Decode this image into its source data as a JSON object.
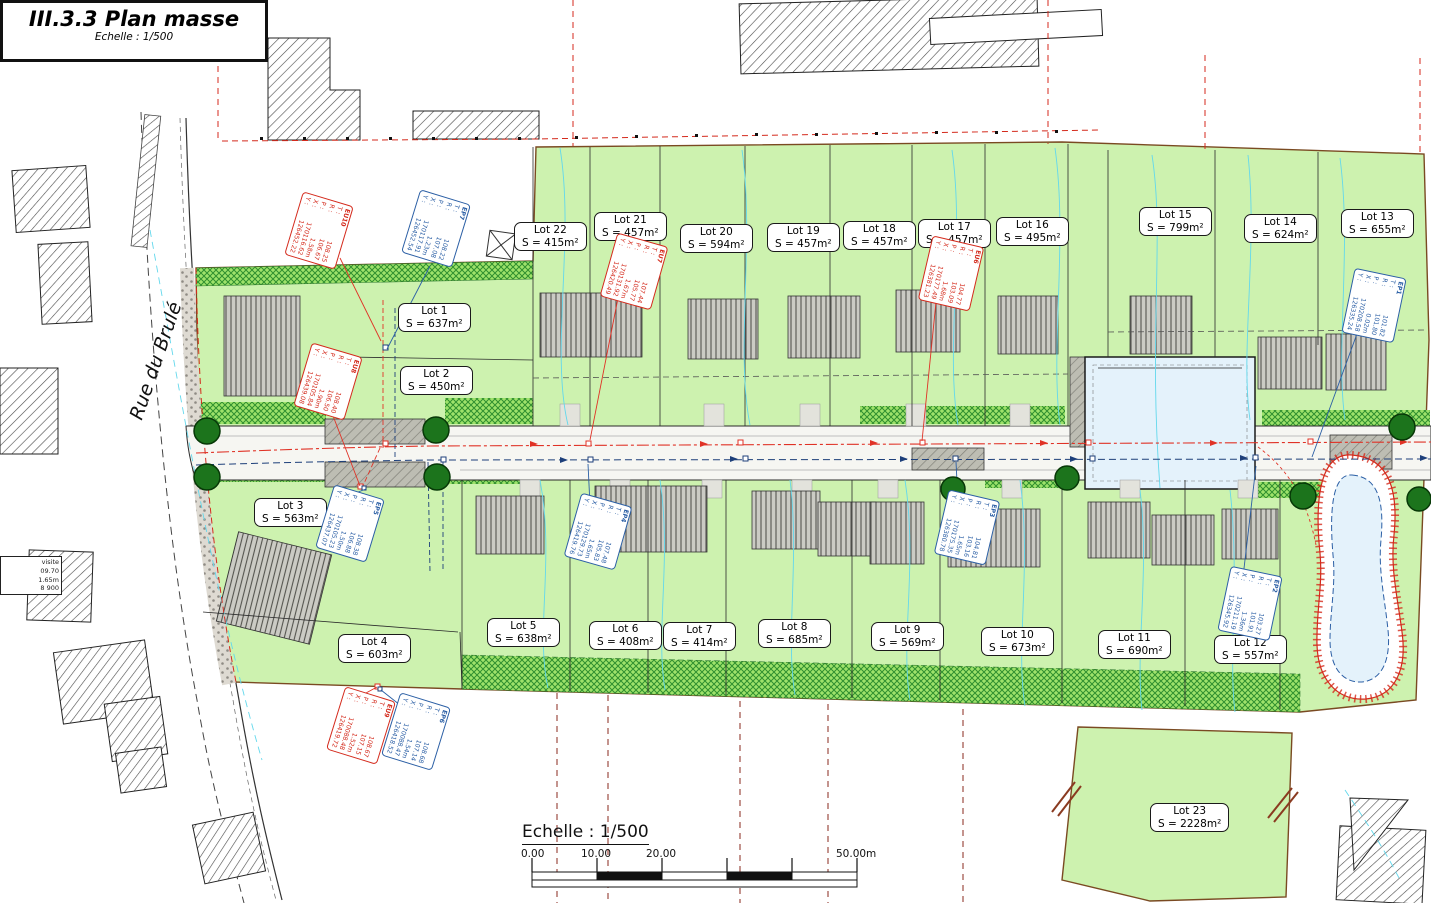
{
  "title_block": {
    "title": "III.3.3 Plan masse",
    "subtitle": "Echelle : 1/500"
  },
  "street_label": "Rue du Brulé",
  "scale_bar": {
    "label": "Echelle : 1/500",
    "t0": "0.00",
    "t1": "10.00",
    "t2": "20.00",
    "t3": "50.00m"
  },
  "row_labels": {
    "t": "T :",
    "r": "R :",
    "p": "P :",
    "x": "X :",
    "y": "Y :"
  },
  "visite_box": {
    "l1": "visite",
    "l2": "09.70",
    "l3": "1.65m",
    "l4": "8 900"
  },
  "lots": [
    {
      "id": "Lot 1",
      "name": "Lot 1",
      "area": "S = 637m²",
      "x": 398,
      "y": 303
    },
    {
      "id": "Lot 2",
      "name": "Lot 2",
      "area": "S = 450m²",
      "x": 400,
      "y": 366
    },
    {
      "id": "Lot 3",
      "name": "Lot 3",
      "area": "S = 563m²",
      "x": 254,
      "y": 498
    },
    {
      "id": "Lot 4",
      "name": "Lot 4",
      "area": "S = 603m²",
      "x": 338,
      "y": 634
    },
    {
      "id": "Lot 5",
      "name": "Lot 5",
      "area": "S = 638m²",
      "x": 487,
      "y": 618
    },
    {
      "id": "Lot 6",
      "name": "Lot 6",
      "area": "S = 408m²",
      "x": 589,
      "y": 621
    },
    {
      "id": "Lot 7",
      "name": "Lot 7",
      "area": "S = 414m²",
      "x": 663,
      "y": 622
    },
    {
      "id": "Lot 8",
      "name": "Lot 8",
      "area": "S = 685m²",
      "x": 758,
      "y": 619
    },
    {
      "id": "Lot 9",
      "name": "Lot 9",
      "area": "S = 569m²",
      "x": 871,
      "y": 622
    },
    {
      "id": "Lot 10",
      "name": "Lot 10",
      "area": "S = 673m²",
      "x": 981,
      "y": 627
    },
    {
      "id": "Lot 11",
      "name": "Lot 11",
      "area": "S = 690m²",
      "x": 1098,
      "y": 630
    },
    {
      "id": "Lot 12",
      "name": "Lot 12",
      "area": "S = 557m²",
      "x": 1214,
      "y": 635
    },
    {
      "id": "Lot 13",
      "name": "Lot 13",
      "area": "S = 655m²",
      "x": 1341,
      "y": 209
    },
    {
      "id": "Lot 14",
      "name": "Lot 14",
      "area": "S = 624m²",
      "x": 1244,
      "y": 214
    },
    {
      "id": "Lot 15",
      "name": "Lot 15",
      "area": "S = 799m²",
      "x": 1139,
      "y": 207
    },
    {
      "id": "Lot 16",
      "name": "Lot 16",
      "area": "S = 495m²",
      "x": 996,
      "y": 217
    },
    {
      "id": "Lot 17",
      "name": "Lot 17",
      "area": "S = 457m²",
      "x": 918,
      "y": 219
    },
    {
      "id": "Lot 18",
      "name": "Lot 18",
      "area": "S = 457m²",
      "x": 843,
      "y": 221
    },
    {
      "id": "Lot 19",
      "name": "Lot 19",
      "area": "S = 457m²",
      "x": 767,
      "y": 223
    },
    {
      "id": "Lot 20",
      "name": "Lot 20",
      "area": "S = 594m²",
      "x": 680,
      "y": 224
    },
    {
      "id": "Lot 21",
      "name": "Lot 21",
      "area": "S = 457m²",
      "x": 594,
      "y": 212
    },
    {
      "id": "Lot 22",
      "name": "Lot 22",
      "area": "S = 415m²",
      "x": 514,
      "y": 222
    },
    {
      "id": "Lot 23",
      "name": "Lot 23",
      "area": "S = 2228m²",
      "x": 1150,
      "y": 803
    }
  ],
  "manholes": [
    {
      "id": "EU10",
      "type": "eu",
      "x": 286,
      "y": 204,
      "t": "108.25",
      "r": "106.67",
      "p": "1.58m",
      "cx": "170116.62",
      "cy": "126452.22"
    },
    {
      "id": "EP7",
      "type": "ep",
      "x": 403,
      "y": 202,
      "t": "108.22",
      "r": "107.08",
      "p": "1.23m",
      "cx": "170117.91",
      "cy": "126452.54"
    },
    {
      "id": "EU8",
      "type": "eu",
      "x": 295,
      "y": 355,
      "t": "108.40",
      "r": "106.50",
      "p": "1.90m",
      "cx": "170105.84",
      "cy": "126439.08"
    },
    {
      "id": "EU7",
      "type": "eu",
      "x": 601,
      "y": 245,
      "t": "107.44",
      "r": "105.77",
      "p": "1.67m",
      "cx": "170131.92",
      "cy": "126420.49"
    },
    {
      "id": "EU6",
      "type": "eu",
      "x": 918,
      "y": 247,
      "t": "104.77",
      "r": "103.09",
      "p": "1.68m",
      "cx": "170177.49",
      "cy": "126381.23"
    },
    {
      "id": "EP5",
      "type": "ep",
      "x": 317,
      "y": 497,
      "t": "108.38",
      "r": "106.88",
      "p": "1.50m",
      "cx": "170105.23",
      "cy": "126437.07"
    },
    {
      "id": "EU9",
      "type": "eu",
      "x": 328,
      "y": 699,
      "t": "108.67",
      "r": "107.15",
      "p": "1.52m",
      "cx": "170088.48",
      "cy": "126419.72"
    },
    {
      "id": "EP6",
      "type": "ep",
      "x": 383,
      "y": 705,
      "t": "108.68",
      "r": "107.14",
      "p": "1.54m",
      "cx": "170088.47",
      "cy": "126418.52"
    },
    {
      "id": "EP4",
      "type": "ep",
      "x": 565,
      "y": 505,
      "t": "107.48",
      "r": "105.83",
      "p": "1.65m",
      "cx": "170129.73",
      "cy": "126419.76"
    },
    {
      "id": "EP3",
      "type": "ep",
      "x": 934,
      "y": 501,
      "t": "104.81",
      "r": "103.16",
      "p": "1.65m",
      "cx": "170175.35",
      "cy": "126380.78"
    },
    {
      "id": "EP2",
      "type": "ep",
      "x": 1217,
      "y": 577,
      "t": "103.27",
      "r": "101.91",
      "p": "1.36m",
      "cx": "170211.19",
      "cy": "126345.92"
    },
    {
      "id": "EP1",
      "type": "ep",
      "x": 1341,
      "y": 279,
      "t": "101.82",
      "r": "101.80",
      "p": "0.02m",
      "cx": "170208.58",
      "cy": "126335.24"
    }
  ],
  "parcels": [
    {
      "t": "274F",
      "x": 408,
      "y": 48
    },
    {
      "t": "274E",
      "x": 843,
      "y": 18
    },
    {
      "t": "272E",
      "x": 370,
      "y": 192
    },
    {
      "t": "272G",
      "x": 370,
      "y": 284
    },
    {
      "t": "271L",
      "x": 350,
      "y": 360
    },
    {
      "t": "268C",
      "x": 406,
      "y": 528
    },
    {
      "t": "380W",
      "x": 298,
      "y": 708
    },
    {
      "t": "379A2",
      "x": 430,
      "y": 742
    },
    {
      "t": "379C2",
      "x": 500,
      "y": 728
    },
    {
      "t": "378W2",
      "x": 566,
      "y": 730
    },
    {
      "t": "378T2",
      "x": 655,
      "y": 745
    },
    {
      "t": "378V2",
      "x": 766,
      "y": 757
    },
    {
      "t": "378S2",
      "x": 868,
      "y": 770
    },
    {
      "t": "377",
      "x": 1178,
      "y": 775
    },
    {
      "t": "376R",
      "x": 1362,
      "y": 840
    },
    {
      "t": "389Z8",
      "x": 1084,
      "y": 884
    },
    {
      "t": "389S",
      "x": 1140,
      "y": 888
    },
    {
      "t": "389T",
      "x": 1196,
      "y": 891
    }
  ],
  "parking": [
    {
      "t": "Parking",
      "x": 336,
      "y": 423
    },
    {
      "t": "Parking",
      "x": 336,
      "y": 467
    },
    {
      "t": "Parking",
      "x": 922,
      "y": 451
    },
    {
      "t": "Parking",
      "x": 1070,
      "y": 384
    },
    {
      "t": "Parking",
      "x": 1342,
      "y": 441,
      "r": -8
    }
  ],
  "pipes": [
    {
      "t": "PVC DN315 32.00m  -2.29%",
      "x": 440,
      "y": 431,
      "r": -12,
      "c": "r"
    },
    {
      "t": "PVC DN315 30.00m  -2.50%",
      "x": 442,
      "y": 455,
      "r": -9,
      "c": "b"
    },
    {
      "t": "PVC DN315 60.25m  -4.47%",
      "x": 740,
      "y": 418,
      "r": -3,
      "c": "r"
    },
    {
      "t": "PVC DN315 60.00m  -4.96%",
      "x": 742,
      "y": 443,
      "r": -3,
      "c": "b"
    },
    {
      "t": "PVC DN315 62.23m  -3.70%",
      "x": 1128,
      "y": 429,
      "r": -5,
      "c": "r"
    },
    {
      "t": "PVC DN315 50.00m  -2.50%",
      "x": 1084,
      "y": 443,
      "r": -2,
      "c": "b"
    },
    {
      "t": "PVC DN200 17.00m",
      "x": 371,
      "y": 430,
      "r": -90,
      "c": "r"
    },
    {
      "t": "PVC DN200 17.00m",
      "x": 398,
      "y": 430,
      "r": -90,
      "c": "b"
    },
    {
      "t": "PVC DN200 26.00m  -2.53%",
      "x": 425,
      "y": 575,
      "r": -90,
      "c": "b"
    },
    {
      "t": "PVC DN200 26.00m  -1.00%",
      "x": 450,
      "y": 575,
      "r": -90,
      "c": "r"
    },
    {
      "t": "DN315 3.00m",
      "x": 1296,
      "y": 472,
      "r": -58,
      "c": "b"
    }
  ],
  "dims": [
    {
      "t": "-8.31m-",
      "x": 549,
      "y": 143
    },
    {
      "t": "-11.50m-",
      "x": 612,
      "y": 143
    },
    {
      "t": "-14.99m-",
      "x": 688,
      "y": 142
    },
    {
      "t": "-11.50m-",
      "x": 776,
      "y": 142
    },
    {
      "t": "-11.90m-",
      "x": 846,
      "y": 141
    },
    {
      "t": "-11.50m-",
      "x": 914,
      "y": 141
    },
    {
      "t": "-13.41m-",
      "x": 998,
      "y": 142
    },
    {
      "t": "-15.41m-",
      "x": 1080,
      "y": 143
    },
    {
      "t": "-25.13m-",
      "x": 1146,
      "y": 142
    },
    {
      "t": "-13.04m-",
      "x": 1258,
      "y": 144
    },
    {
      "t": "-15.06m-",
      "x": 1356,
      "y": 146
    },
    {
      "t": "6.98m",
      "x": 146,
      "y": 140,
      "c": "k"
    },
    {
      "t": "-49.00m-",
      "x": 338,
      "y": 271
    },
    {
      "t": "-1.00m-",
      "x": 498,
      "y": 271
    },
    {
      "t": "-43.46m-",
      "x": 308,
      "y": 341,
      "r": -6
    },
    {
      "t": "1.50m",
      "x": 204,
      "y": 324,
      "c": "k"
    },
    {
      "t": "-37.97m-",
      "x": 316,
      "y": 407
    },
    {
      "t": "-38.70m-",
      "x": 306,
      "y": 483
    },
    {
      "t": "-33.67m-",
      "x": 323,
      "y": 671,
      "r": -4
    },
    {
      "t": "-4.73m-",
      "x": 188,
      "y": 298,
      "r": -72
    },
    {
      "t": "-6.44m-",
      "x": 194,
      "y": 324,
      "r": -72
    },
    {
      "t": "-8.78m-",
      "x": 190,
      "y": 362,
      "r": -76
    },
    {
      "t": "-3.68m-",
      "x": 188,
      "y": 489,
      "r": -78
    },
    {
      "t": "-6.99m-",
      "x": 48,
      "y": 646,
      "r": -80
    },
    {
      "t": "-6.7m-",
      "x": 78,
      "y": 830,
      "r": -15
    },
    {
      "t": "-5.08m-",
      "x": 446,
      "y": 401,
      "r": -20
    },
    {
      "t": "-6.00m-",
      "x": 482,
      "y": 360,
      "r": -65
    },
    {
      "t": "-6.15m-",
      "x": 574,
      "y": 388
    },
    {
      "t": "-14.94m-",
      "x": 710,
      "y": 387
    },
    {
      "t": "-11.50m-",
      "x": 788,
      "y": 387
    },
    {
      "t": "-11.50m-",
      "x": 856,
      "y": 388
    },
    {
      "t": "11.50m",
      "x": 926,
      "y": 388
    },
    {
      "t": "-12.43m-",
      "x": 994,
      "y": 389
    },
    {
      "t": "-26.13m-",
      "x": 1122,
      "y": 337
    },
    {
      "t": "-4.13m-",
      "x": 1222,
      "y": 338
    },
    {
      "t": "-11.00m-",
      "x": 1340,
      "y": 370,
      "r": -86
    },
    {
      "t": "-11.50m-",
      "x": 1278,
      "y": 403
    },
    {
      "t": "-15.55m-",
      "x": 1362,
      "y": 402
    },
    {
      "t": "-15.30m-",
      "x": 486,
      "y": 479,
      "r": -8
    },
    {
      "t": "-4.00m-",
      "x": 546,
      "y": 467
    },
    {
      "t": "-11.50m-",
      "x": 596,
      "y": 467
    },
    {
      "t": "-11.50m-",
      "x": 670,
      "y": 467
    },
    {
      "t": "-18.63m-",
      "x": 764,
      "y": 469
    },
    {
      "t": "-15.13m-",
      "x": 874,
      "y": 468
    },
    {
      "t": "-19.01m-",
      "x": 946,
      "y": 481,
      "r": -3
    },
    {
      "t": "-18.99m-",
      "x": 1100,
      "y": 478
    },
    {
      "t": "-15.00m-",
      "x": 1220,
      "y": 480
    },
    {
      "t": "-21.24m-",
      "x": 1336,
      "y": 487
    },
    {
      "t": "-39.97m-",
      "x": 527,
      "y": 196,
      "r": -88
    },
    {
      "t": "-39.78m-",
      "x": 579,
      "y": 258,
      "r": -88
    },
    {
      "t": "-39.77m-",
      "x": 730,
      "y": 258,
      "r": -88
    },
    {
      "t": "-39.78m-",
      "x": 817,
      "y": 258,
      "r": -88
    },
    {
      "t": "-39.79m-",
      "x": 923,
      "y": 258,
      "r": -88
    },
    {
      "t": "-39.79m-",
      "x": 1003,
      "y": 240,
      "r": -88
    },
    {
      "t": "-31.79m-",
      "x": 1085,
      "y": 222,
      "r": -88
    },
    {
      "t": "-31.80m-",
      "x": 1231,
      "y": 240,
      "r": -88
    },
    {
      "t": "-42.81m-",
      "x": 1325,
      "y": 240,
      "r": -88
    },
    {
      "t": "-42.81m-",
      "x": 1413,
      "y": 240,
      "r": -88
    },
    {
      "t": "-35.63m-",
      "x": 577,
      "y": 562,
      "r": -88
    },
    {
      "t": "-36.77m-",
      "x": 653,
      "y": 568,
      "r": -88
    },
    {
      "t": "-36.32m-",
      "x": 731,
      "y": 564,
      "r": -88
    },
    {
      "t": "-37.22m-",
      "x": 829,
      "y": 568,
      "r": -88
    },
    {
      "t": "-35.67m-",
      "x": 923,
      "y": 572,
      "r": -88
    },
    {
      "t": "-35.87m-",
      "x": 1039,
      "y": 578,
      "r": -88
    },
    {
      "t": "-36.78m-",
      "x": 1158,
      "y": 582,
      "r": -88
    },
    {
      "t": "-37.54m-",
      "x": 1220,
      "y": 592,
      "r": -88
    },
    {
      "t": "-38.56m-",
      "x": 1390,
      "y": 582,
      "r": -88
    },
    {
      "t": "-12.59m-",
      "x": 446,
      "y": 515,
      "r": -88
    },
    {
      "t": "-18.18m-",
      "x": 413,
      "y": 550,
      "r": -88
    },
    {
      "t": "-18.79m-",
      "x": 440,
      "y": 618,
      "r": -88
    },
    {
      "t": "-11.52m-",
      "x": 564,
      "y": 686,
      "r": -2
    },
    {
      "t": "-11.5m-",
      "x": 623,
      "y": 688,
      "r": -2
    },
    {
      "t": "-18.65m-",
      "x": 700,
      "y": 693,
      "r": -3
    },
    {
      "t": "-15.15m-",
      "x": 786,
      "y": 698,
      "r": -3
    },
    {
      "t": "-19.09m-",
      "x": 875,
      "y": 704,
      "r": -3
    },
    {
      "t": "-19.04m-",
      "x": 988,
      "y": 708,
      "r": -3
    },
    {
      "t": "-33.41m-",
      "x": 1170,
      "y": 725,
      "r": -2
    },
    {
      "t": "-15.02m-",
      "x": 1230,
      "y": 716,
      "r": -2
    },
    {
      "t": "-21.12m-",
      "x": 1345,
      "y": 722,
      "r": -2
    },
    {
      "t": "-66.99m-",
      "x": 1074,
      "y": 752,
      "r": -86
    },
    {
      "t": "-68.74m-",
      "x": 1278,
      "y": 752,
      "r": -82
    },
    {
      "t": "-34.78m-",
      "x": 1290,
      "y": 756,
      "r": -86
    },
    {
      "t": "-6.86m-",
      "x": 1083,
      "y": 861,
      "r": -12
    },
    {
      "t": "-25.60m-",
      "x": 1208,
      "y": 873,
      "r": -4
    },
    {
      "t": "-27.26m-",
      "x": 1150,
      "y": 359,
      "c": "k"
    },
    {
      "t": "20.00m",
      "x": 1084,
      "y": 403,
      "r": -90,
      "c": "k"
    },
    {
      "t": "4.00m",
      "x": 692,
      "y": 436,
      "r": -90,
      "c": "k"
    },
    {
      "t": "A 1",
      "x": 241,
      "y": 136,
      "c": "k"
    },
    {
      "t": "A 2",
      "x": 512,
      "y": 264,
      "c": "k"
    },
    {
      "t": "A 4",
      "x": 594,
      "y": 126,
      "c": "k"
    },
    {
      "t": "109.00",
      "x": 16,
      "y": 404,
      "r": -72,
      "c": "c"
    },
    {
      "t": "108.50",
      "x": 112,
      "y": 529,
      "r": -60,
      "c": "c"
    },
    {
      "t": "109.50",
      "x": 281,
      "y": 786,
      "r": -52,
      "c": "c"
    },
    {
      "t": "104.00",
      "x": 1164,
      "y": 388,
      "r": -80,
      "c": "c"
    },
    {
      "t": "103.50",
      "x": 1218,
      "y": 381,
      "r": -72,
      "c": "c"
    },
    {
      "t": "107",
      "x": 638,
      "y": 562,
      "r": -85,
      "c": "c"
    },
    {
      "t": "106",
      "x": 866,
      "y": 558,
      "r": -85,
      "c": "c"
    }
  ]
}
